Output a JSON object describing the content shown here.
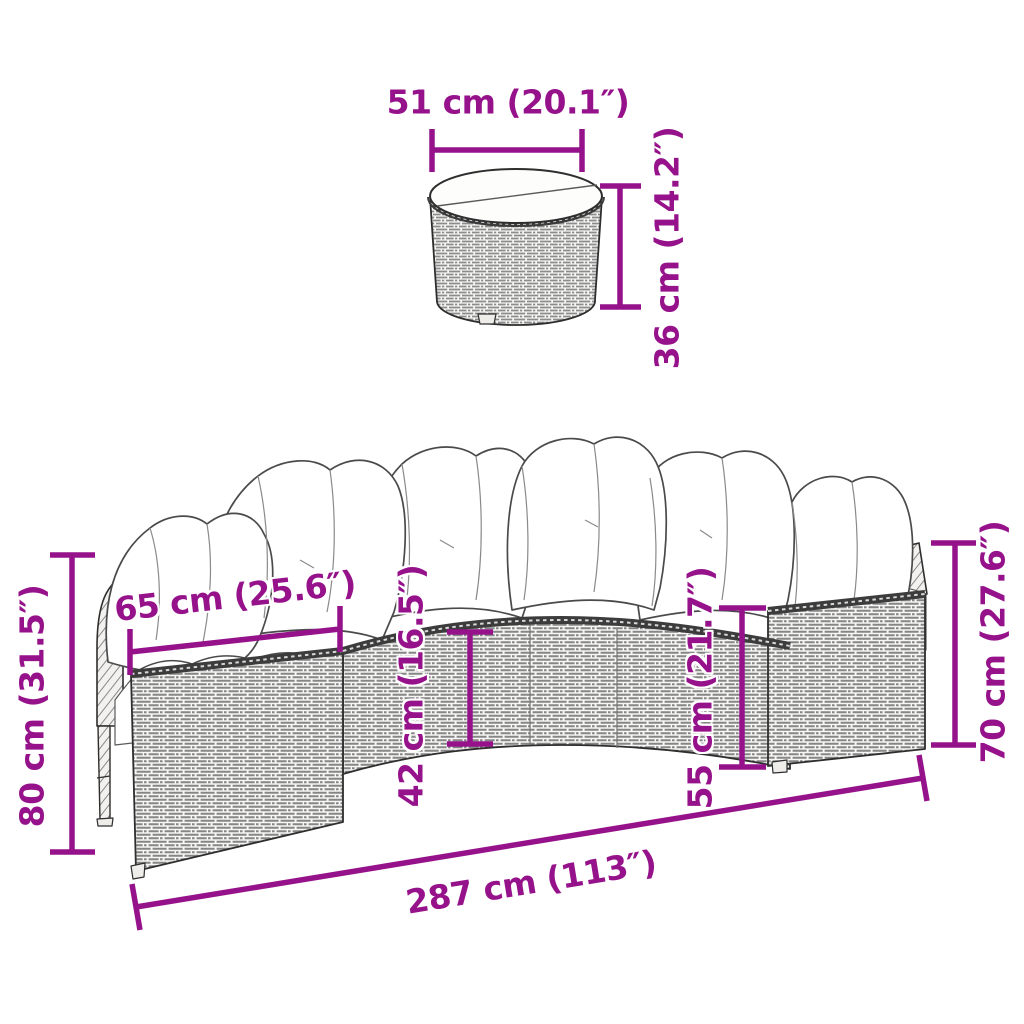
{
  "meta": {
    "kind": "product-dimension-diagram",
    "subject": "half-round poly rattan garden sofa with cushions and round table",
    "background": "#ffffff",
    "accent_color": "#96128B",
    "line_color": "#2e2e2e"
  },
  "labels": {
    "table_width": "51 cm (20.1″)",
    "table_height": "36 cm (14.2″)",
    "seat_depth": "65 cm (25.6″)",
    "back_height": "80 cm (31.5″)",
    "seat_height": "42 cm (16.5″)",
    "section_height": "55 cm (21.7″)",
    "side_height": "70 cm (27.6″)",
    "total_width": "287 cm (113″)"
  }
}
